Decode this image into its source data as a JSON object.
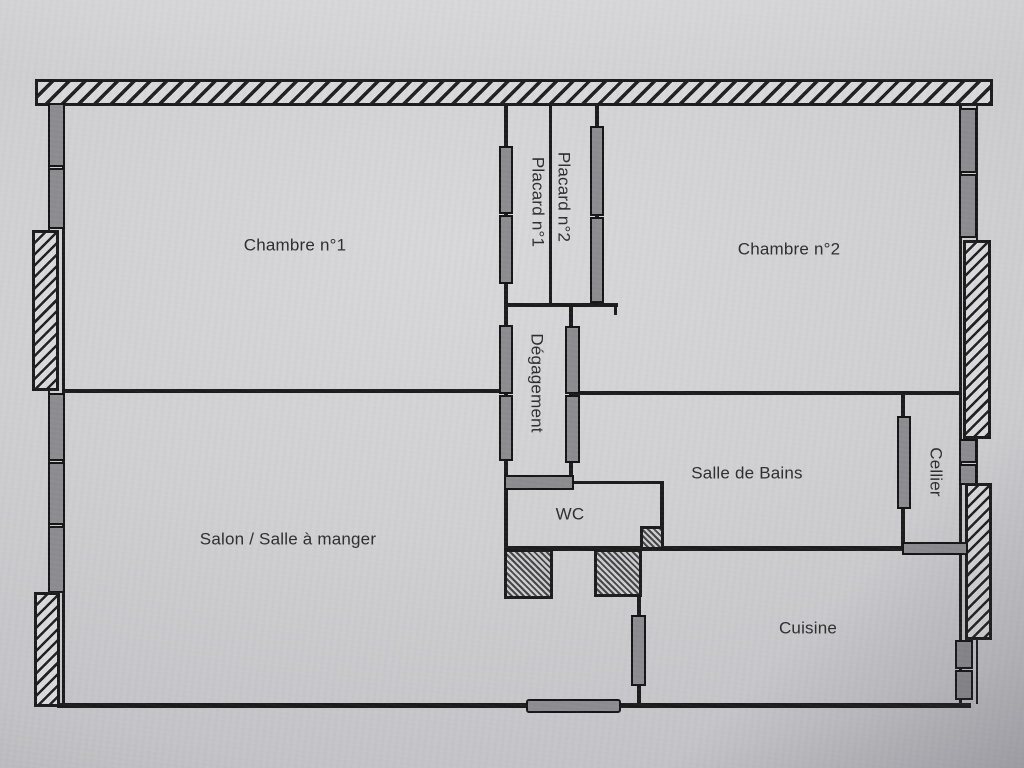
{
  "title": "Plan d'appartement",
  "rooms": {
    "chambre1": "Chambre n°1",
    "chambre2": "Chambre n°2",
    "placard1": "Placard n°1",
    "placard2": "Placard n°2",
    "degagement": "Dégagement",
    "salle_de_bains": "Salle de Bains",
    "wc": "WC",
    "salon": "Salon / Salle à manger",
    "cellier": "Cellier",
    "cuisine": "Cuisine"
  },
  "colors": {
    "wall": "#1b1b1b",
    "fixture": "#8c8c90",
    "text": "#2d2d30",
    "paper": "#d0d0d3"
  }
}
